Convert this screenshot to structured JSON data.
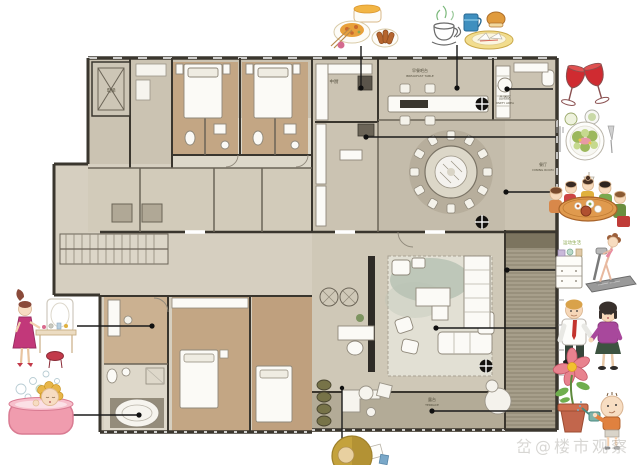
{
  "palette": {
    "wall": "#3a362e",
    "floor_light": "#d6cfc0",
    "floor_mid": "#cbc3b2",
    "wood": "#c3a684",
    "terrace": "#a79f8b",
    "wine_red": "#cf2b31",
    "tub_pink": "#f09cae",
    "callout": "#1b1b1b"
  },
  "watermark": {
    "text": "岔@楼市观察"
  },
  "rooms": {
    "elevator": {
      "zh": "电梯",
      "en": ""
    },
    "kitchen": {
      "zh": "中厨",
      "en": ""
    },
    "breakfast": {
      "zh": "早餐吧台",
      "en": "BREAKFAST TABLE"
    },
    "bar": {
      "zh": "品酒区",
      "en": "PARTY AREA"
    },
    "dining": {
      "zh": "餐厅",
      "en": "DINING ROOM"
    },
    "terrace": {
      "zh": "露台",
      "en": "TERRACE"
    }
  },
  "gym_caption": "运动生活",
  "illustrations": [
    {
      "id": "chinese-food",
      "meaning": "Chinese dishes and noodle bowl"
    },
    {
      "id": "coffee",
      "meaning": "coffee cup with steam"
    },
    {
      "id": "mug-sandwich",
      "meaning": "blue mug, bun and sandwich plate"
    },
    {
      "id": "wine-glasses",
      "meaning": "two red wine glasses toasting"
    },
    {
      "id": "salad-plate",
      "meaning": "salad plate with fork and knife"
    },
    {
      "id": "family-dinner",
      "meaning": "family dining around a table"
    },
    {
      "id": "home-gym",
      "meaning": "woman exercising on treadmill"
    },
    {
      "id": "couple",
      "meaning": "man and woman holding hands"
    },
    {
      "id": "boy-watering-flower",
      "meaning": "child watering a potted flower"
    },
    {
      "id": "lady-vanity",
      "meaning": "woman at a dressing table"
    },
    {
      "id": "girl-bathtub",
      "meaning": "girl in a pink bubble bath"
    },
    {
      "id": "bottom-figure",
      "meaning": "partially cropped figure at bottom edge"
    }
  ],
  "callouts": [
    {
      "from": "chinese-food",
      "to": "kitchen"
    },
    {
      "from": "coffee",
      "to": "breakfast-table"
    },
    {
      "from": "wine-glasses",
      "to": "bar-area"
    },
    {
      "from": "salad-plate",
      "to": "west-kitchen"
    },
    {
      "from": "family-dinner",
      "to": "dining-room"
    },
    {
      "from": "home-gym",
      "to": "side-terrace"
    },
    {
      "from": "couple",
      "to": "living-room"
    },
    {
      "from": "boy-watering-flower",
      "to": "garden-terrace"
    },
    {
      "from": "lady-vanity",
      "to": "dressing-room"
    },
    {
      "from": "girl-bathtub",
      "to": "master-bathroom"
    },
    {
      "from": "bottom-figure",
      "to": "terrace-edge"
    }
  ]
}
